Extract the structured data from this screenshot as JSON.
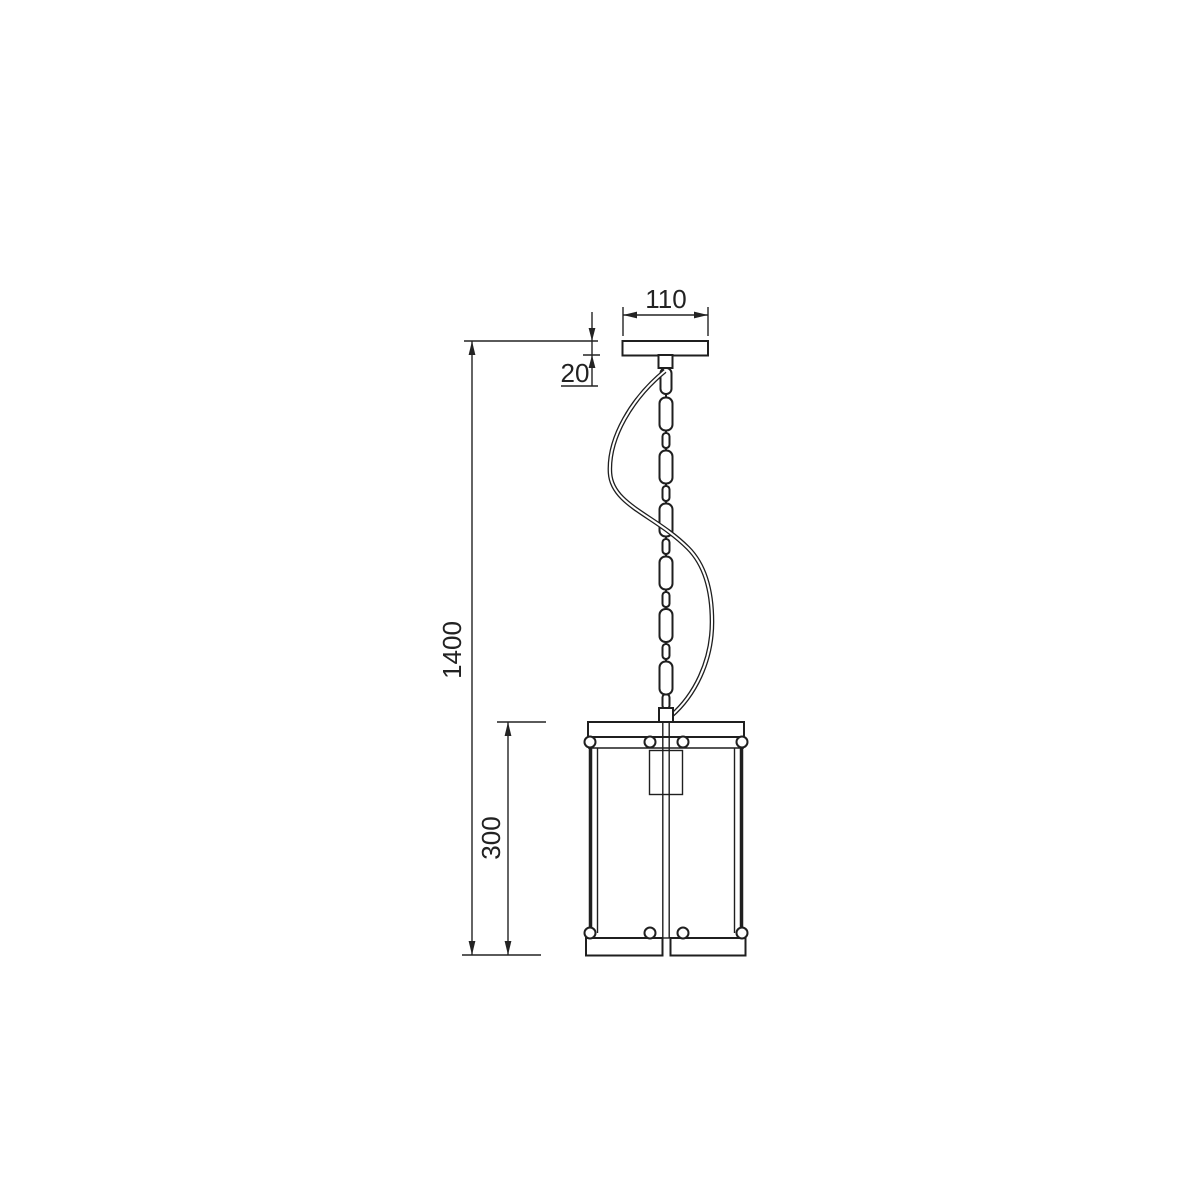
{
  "drawing": {
    "background": "#ffffff",
    "line_color": "#1f1f1f",
    "dimension_color": "#232323",
    "dimensions": {
      "canopy_width": {
        "label": "110"
      },
      "canopy_height": {
        "label": "20"
      },
      "overall_height": {
        "label": "1400"
      },
      "shade_height": {
        "label": "300"
      }
    }
  }
}
